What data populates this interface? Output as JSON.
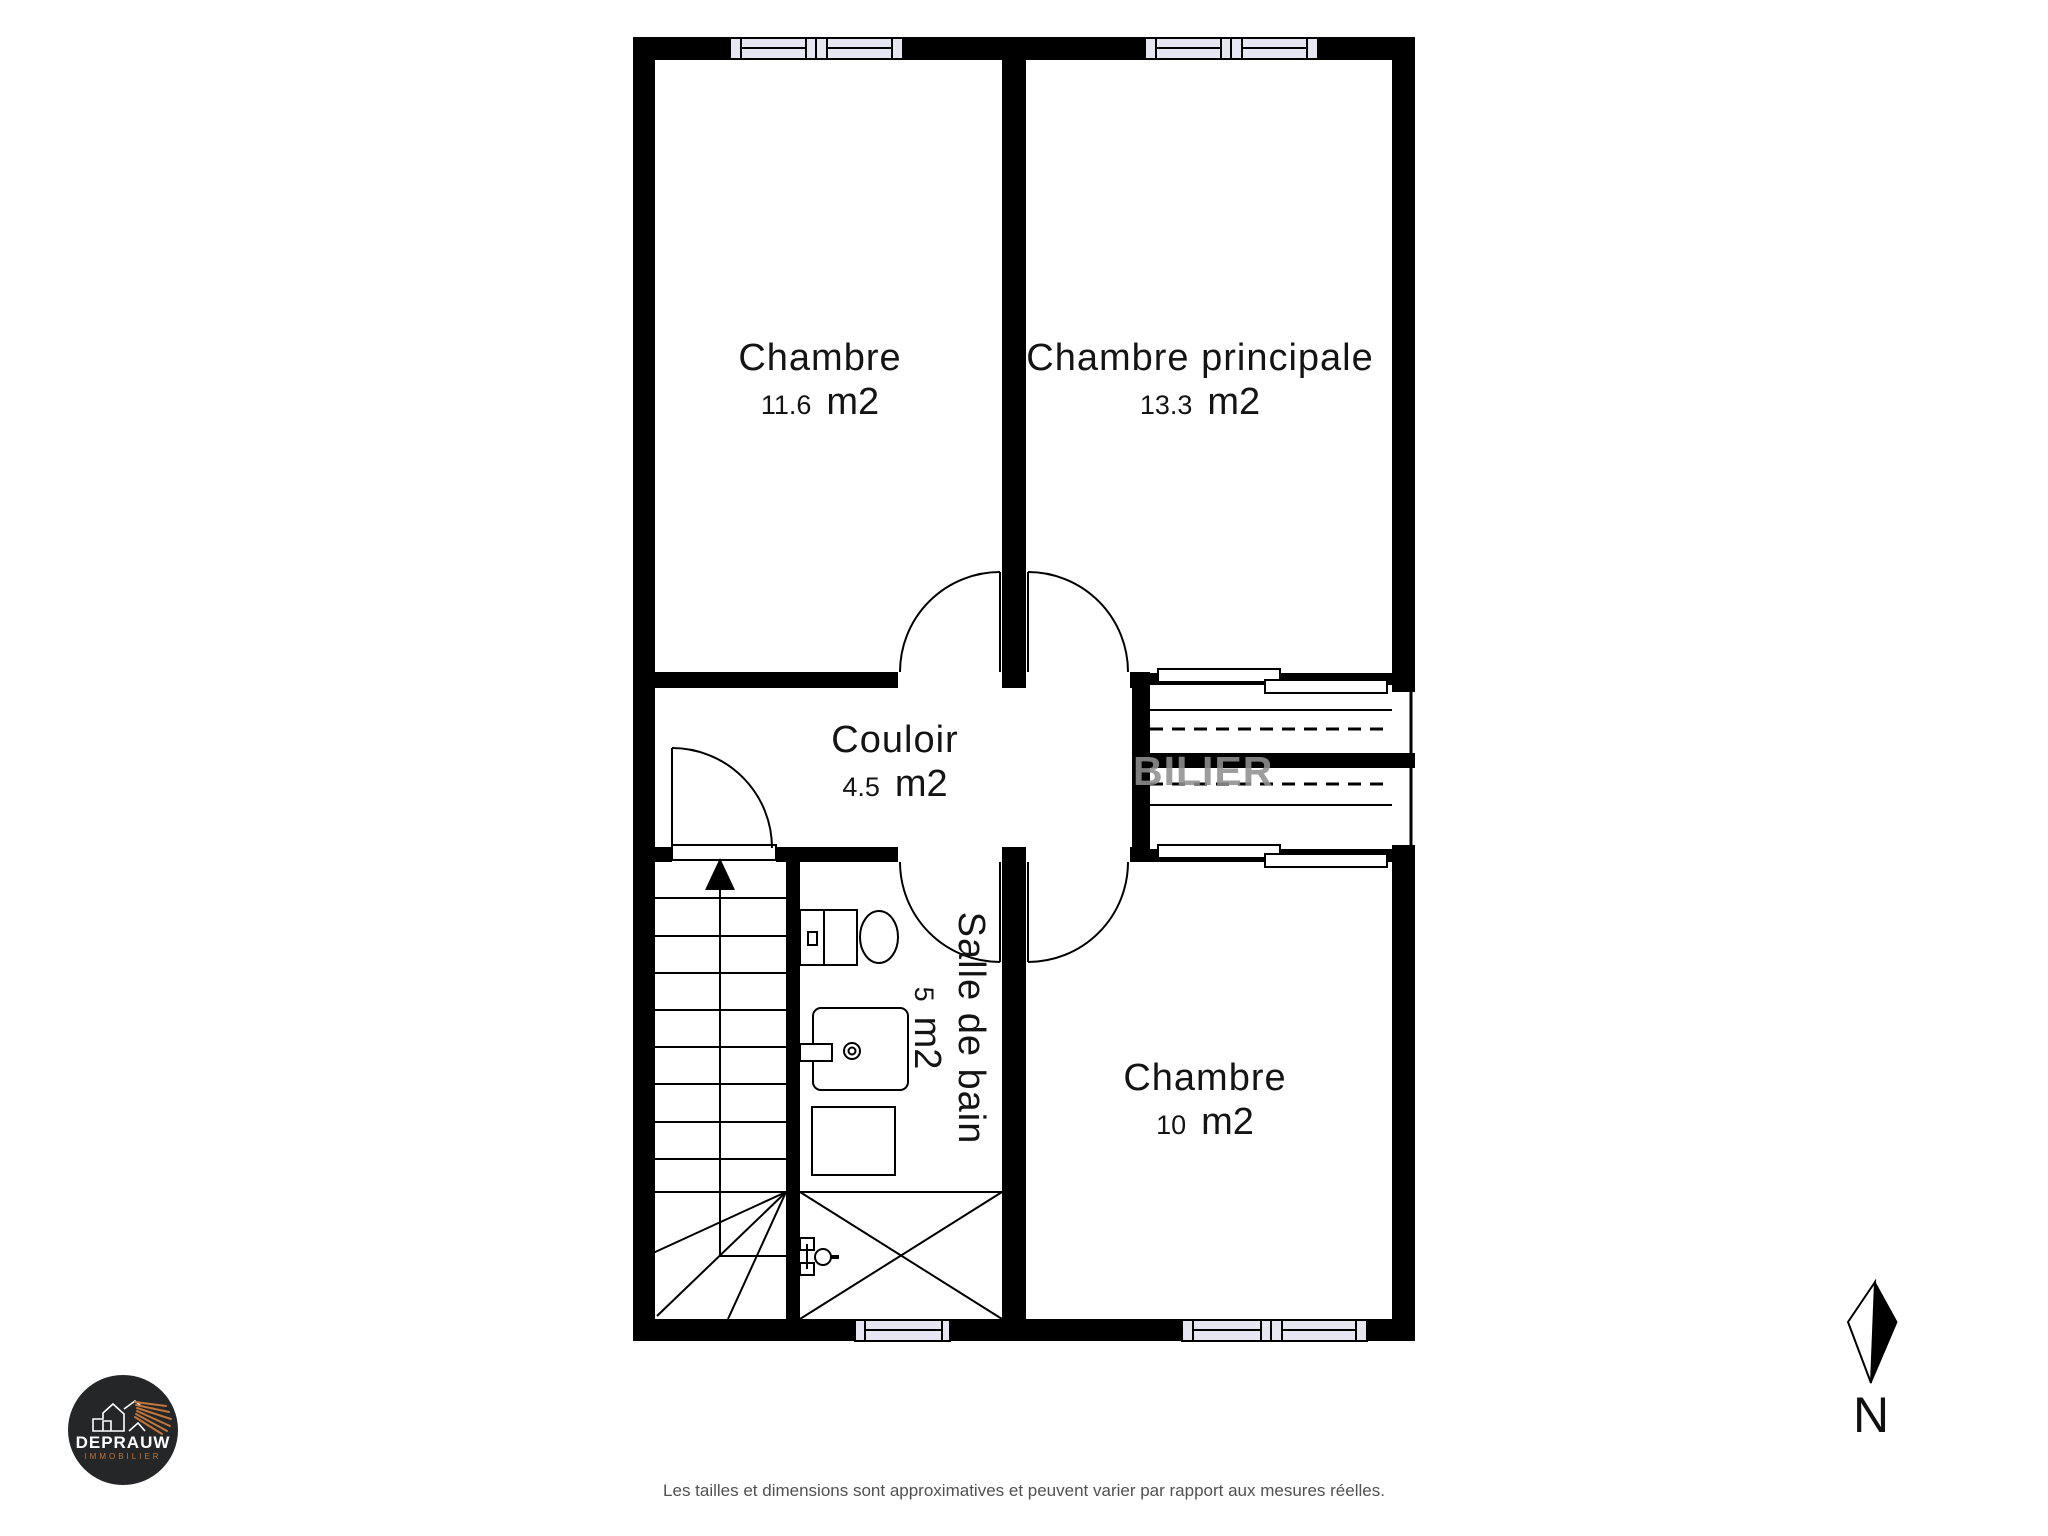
{
  "plan": {
    "rooms": [
      {
        "name": "Chambre",
        "area": "11.6",
        "unit": "m2"
      },
      {
        "name": "Chambre principale",
        "area": "13.3",
        "unit": "m2"
      },
      {
        "name": "Couloir",
        "area": "4.5",
        "unit": "m2"
      },
      {
        "name": "Salle de bain",
        "area": "5",
        "unit": "m2"
      },
      {
        "name": "Chambre",
        "area": "10",
        "unit": "m2"
      }
    ],
    "watermark_text": "BILIER",
    "compass_label": "N"
  },
  "logo": {
    "brand": "DEPRAUW",
    "tagline": "IMMOBILIER"
  },
  "footer": {
    "disclaimer": "Les tailles et dimensions sont approximatives et peuvent varier par rapport aux mesures réelles."
  },
  "colors": {
    "wall": "#000000",
    "window_fill": "#e6e6f2",
    "watermark": "#909090",
    "logo_background": "#242628",
    "logo_accent": "#c0763c",
    "disclaimer_text": "#515151"
  }
}
